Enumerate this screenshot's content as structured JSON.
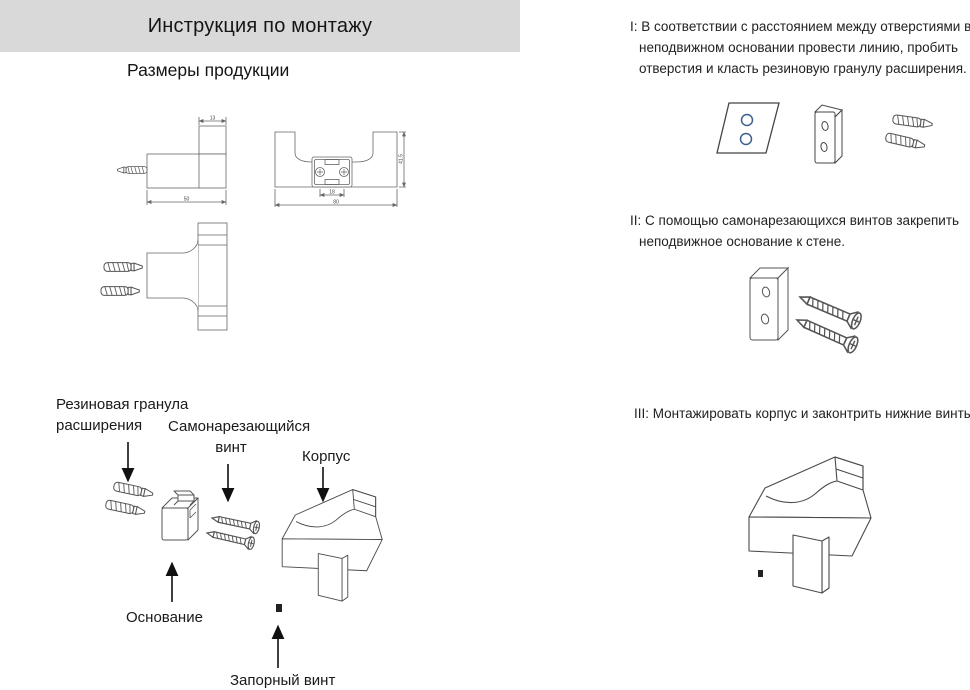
{
  "page": {
    "title": "Инструкция по монтажу",
    "subtitle": "Размеры продукции"
  },
  "steps": [
    {
      "id": "I",
      "text": "I: В соответствии с расстоянием между отверстиями в неподвижном основании провести линию, пробить отверстия и класть резиновую гранулу расширения."
    },
    {
      "id": "II",
      "text": "II: С помощью самонарезающихся винтов закрепить неподвижное основание к стене."
    },
    {
      "id": "III",
      "text": "III: Монтажировать корпус и законтрить нижние винты."
    }
  ],
  "part_labels": {
    "anchor_line1": "Резиновая гранула",
    "anchor_line2": "расширения",
    "screw_line1": "Самонарезающийся",
    "screw_line2": "винт",
    "body": "Корпус",
    "base": "Основание",
    "lock_screw": "Запорный винт"
  },
  "dimensions": {
    "side_hook_width": "13",
    "side_length": "50",
    "front_height": "41.5",
    "front_hole_spacing": "18",
    "front_width": "80"
  },
  "colors": {
    "accent_blue": "#3d5f8f",
    "header_bg": "#d9d9d9",
    "line_art": "#555555"
  }
}
